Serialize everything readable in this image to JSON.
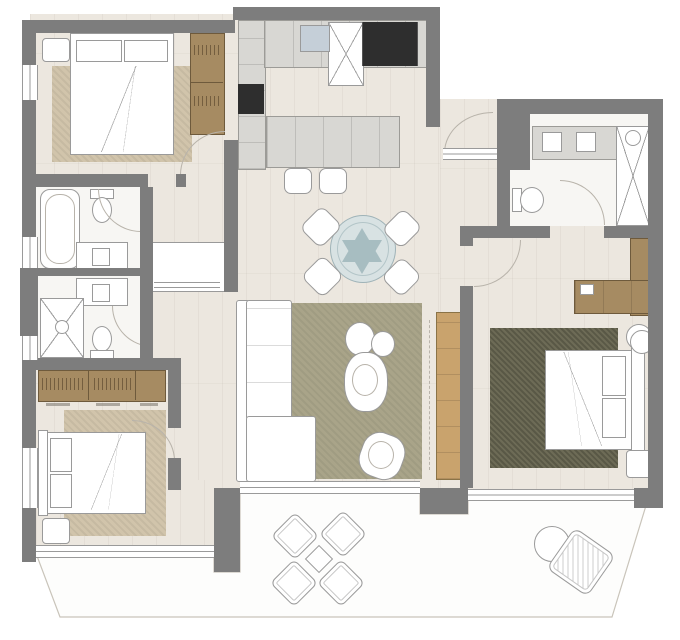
{
  "meta": {
    "type": "apartment-floor-plan",
    "view": "top-down architectural drawing, no text labels visible"
  },
  "colors": {
    "wall": "#7d7d7d",
    "floor": "#ece7df",
    "bath-floor": "#f7f6f3",
    "rug-tan": "#d1c4ab",
    "rug-olive": "#a9a489",
    "rug-dark": "#6d6b56",
    "wood": "#a68b62",
    "wood-light": "#c9a36d",
    "appliance-dark": "#2e2e2e",
    "counter": "#d8d7d3",
    "sink-blue": "#c5cfd8",
    "dining-table": "#d8e2e3",
    "dining-star": "#a7bdc1",
    "line": "#9a9a9a",
    "line-light": "#b8b3aa",
    "terrace": "#fdfdfc",
    "terrace-line": "#c9c4ba",
    "white": "#ffffff"
  },
  "plan": {
    "rooms": [
      {
        "name": "bedroom-top-left",
        "furniture": [
          "double-bed",
          "rug",
          "two-door-wardrobe",
          "nightstand"
        ]
      },
      {
        "name": "bathroom-upper-left",
        "furniture": [
          "bathtub",
          "toilet",
          "vanity-sink"
        ]
      },
      {
        "name": "bathroom-lower-left",
        "furniture": [
          "shower",
          "toilet",
          "vanity-sink"
        ]
      },
      {
        "name": "hallway",
        "furniture": [
          "storage-niche"
        ]
      },
      {
        "name": "kitchen",
        "furniture": [
          "wall-counter",
          "oven-column",
          "sink",
          "tall-unit",
          "fridge-freezer",
          "island",
          "two-bar-stools"
        ]
      },
      {
        "name": "living-dining",
        "furniture": [
          "round-dining-table-star-base",
          "four-dining-chairs",
          "l-shaped-sofa",
          "coffee-table-group",
          "armchair",
          "tv-sideboard"
        ]
      },
      {
        "name": "bedroom-bottom-left",
        "furniture": [
          "double-bed",
          "rug",
          "three-section-wardrobe",
          "nightstand",
          "dimension-marks"
        ]
      },
      {
        "name": "master-bedroom",
        "furniture": [
          "double-bed",
          "rug",
          "l-shaped-wardrobe-desk",
          "round-side-table",
          "nightstand",
          "stool"
        ]
      },
      {
        "name": "ensuite-bathroom",
        "furniture": [
          "double-vanity",
          "toilet",
          "walk-in-shower",
          "tall-cabinet"
        ]
      },
      {
        "name": "terrace",
        "furniture": [
          "outdoor-dining-set-four-chairs",
          "outdoor-lounge-chair",
          "round-side-table"
        ]
      }
    ]
  }
}
